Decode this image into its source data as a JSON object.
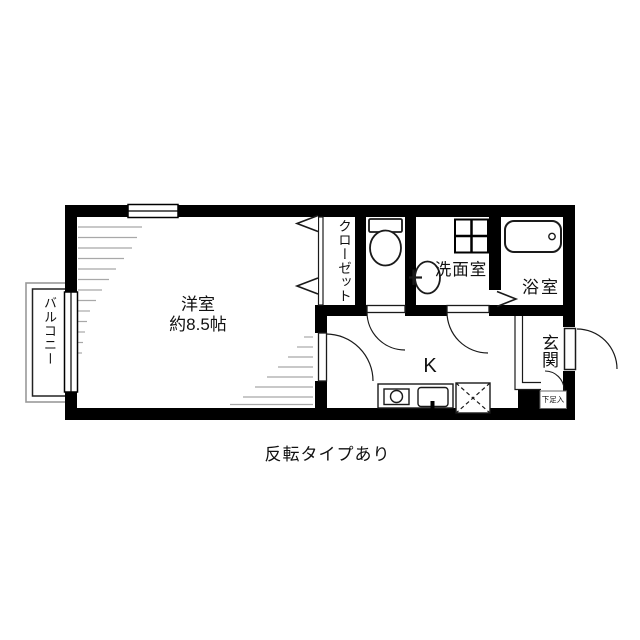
{
  "plan": {
    "caption": "反転タイプあり",
    "labels": {
      "main_room_name": "洋室",
      "main_room_size": "約8.5帖",
      "balcony": "バルコニー",
      "closet": "クローゼット",
      "washroom": "洗面室",
      "bathroom": "浴室",
      "kitchen": "K",
      "entrance": "玄関",
      "shoe_cabinet": "下足入"
    },
    "fixtures": {
      "toilet": "toilet-icon",
      "washbasin": "washbasin-icon",
      "bathtub": "bathtub-icon",
      "washing_machine_pan": "washing-machine-pan-icon",
      "stove": "stove-icon",
      "kitchen_sink": "kitchen-sink-icon",
      "refrigerator_space": "refrigerator-space-icon"
    },
    "colors": {
      "wall": "#000000",
      "outline": "#1a1a1a",
      "hatch": "#a8a8a8",
      "background": "#ffffff"
    }
  }
}
